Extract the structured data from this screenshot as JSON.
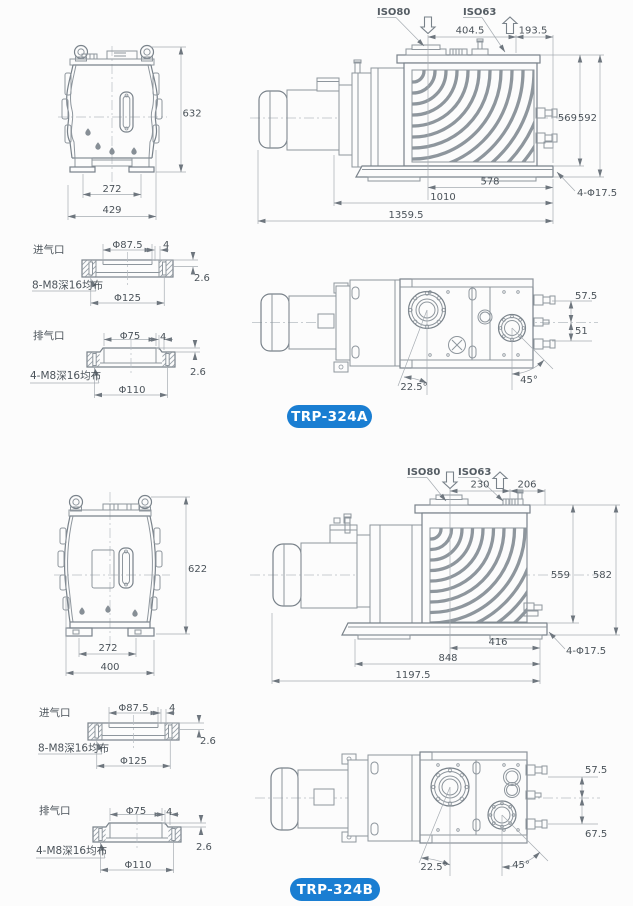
{
  "colors": {
    "accent": "#1a7ed2",
    "line": "#8e969d",
    "dim_text": "#4b535a",
    "background": "#fcfcfc"
  },
  "flanges": {
    "inlet": {
      "title": "进气口",
      "bore_dia": "Φ87.5",
      "lip_width": "4",
      "face_height": "2.6",
      "bolt_note": "8-M8深16均布",
      "bolt_circle": "Φ125"
    },
    "outlet": {
      "title": "排气口",
      "bore_dia": "Φ75",
      "lip_width": "4",
      "face_height": "2.6",
      "bolt_note": "4-M8深16均布",
      "bolt_circle": "Φ110"
    }
  },
  "models": [
    {
      "name": "TRP-324A",
      "front": {
        "total_height": "632",
        "foot_spacing": "272",
        "overall_width": "429"
      },
      "side": {
        "inlet_port": "ISO80",
        "exhaust_port": "ISO63",
        "inlet_to_exhaust": "404.5",
        "exhaust_to_edge": "193.5",
        "height_to_base_top": "569",
        "overall_height": "592",
        "inlet_to_base_end": "578",
        "base_length": "1010",
        "overall_length": "1359.5",
        "mounting_holes": "4-Φ17.5"
      },
      "top": {
        "offset_upper": "57.5",
        "offset_lower": "51",
        "inlet_angle": "22.5°",
        "exhaust_angle": "45°"
      }
    },
    {
      "name": "TRP-324B",
      "front": {
        "total_height": "622",
        "foot_spacing": "272",
        "overall_width": "400"
      },
      "side": {
        "inlet_port": "ISO80",
        "exhaust_port": "ISO63",
        "inlet_to_exhaust": "230",
        "exhaust_to_edge": "206",
        "height_to_base_top": "559",
        "overall_height": "582",
        "inlet_to_base_end": "416",
        "base_length": "848",
        "overall_length": "1197.5",
        "mounting_holes": "4-Φ17.5"
      },
      "top": {
        "offset_upper": "57.5",
        "offset_lower": "67.5",
        "inlet_angle": "22.5°",
        "exhaust_angle": "45°"
      }
    }
  ]
}
